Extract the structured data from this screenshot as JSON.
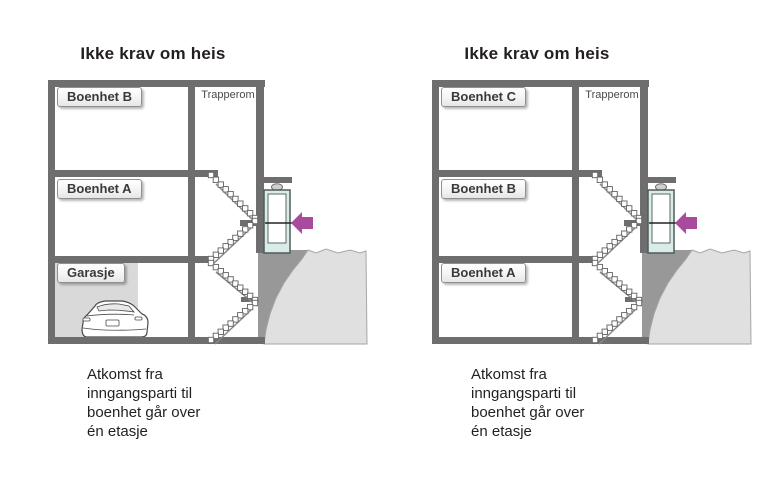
{
  "figure": {
    "background": "#ffffff",
    "description_visible_text_only": true
  },
  "colors": {
    "structure_gray": "#6e6e6e",
    "foundation_gray": "#989898",
    "terrain_gray": "#e0e0e0",
    "terrain_outline": "#a6a6a6",
    "garage_fill": "#d9d9d9",
    "door_frame_teal": "#d9ece8",
    "arrow_magenta": "#a84a9d",
    "text_dark": "#231f20"
  },
  "diagrams": [
    {
      "title": "Ikke krav om heis",
      "stairwell_label": "Trapperom",
      "floors": [
        {
          "label": "Boenhet B"
        },
        {
          "label": "Boenhet A"
        },
        {
          "label": "Garasje"
        }
      ],
      "has_garage_with_car": true,
      "entrance_arrow": {
        "icon": "arrow-left-icon",
        "color": "#a84a9d"
      },
      "caption": "Atkomst fra\ninngangsparti til\nboenhet går over\nén etasje"
    },
    {
      "title": "Ikke krav om heis",
      "stairwell_label": "Trapperom",
      "floors": [
        {
          "label": "Boenhet C"
        },
        {
          "label": "Boenhet B"
        },
        {
          "label": "Boenhet A"
        }
      ],
      "has_garage_with_car": false,
      "entrance_arrow": {
        "icon": "arrow-left-icon",
        "color": "#a84a9d"
      },
      "caption": "Atkomst fra\ninngangsparti til\nboenhet går over\nén etasje"
    }
  ]
}
